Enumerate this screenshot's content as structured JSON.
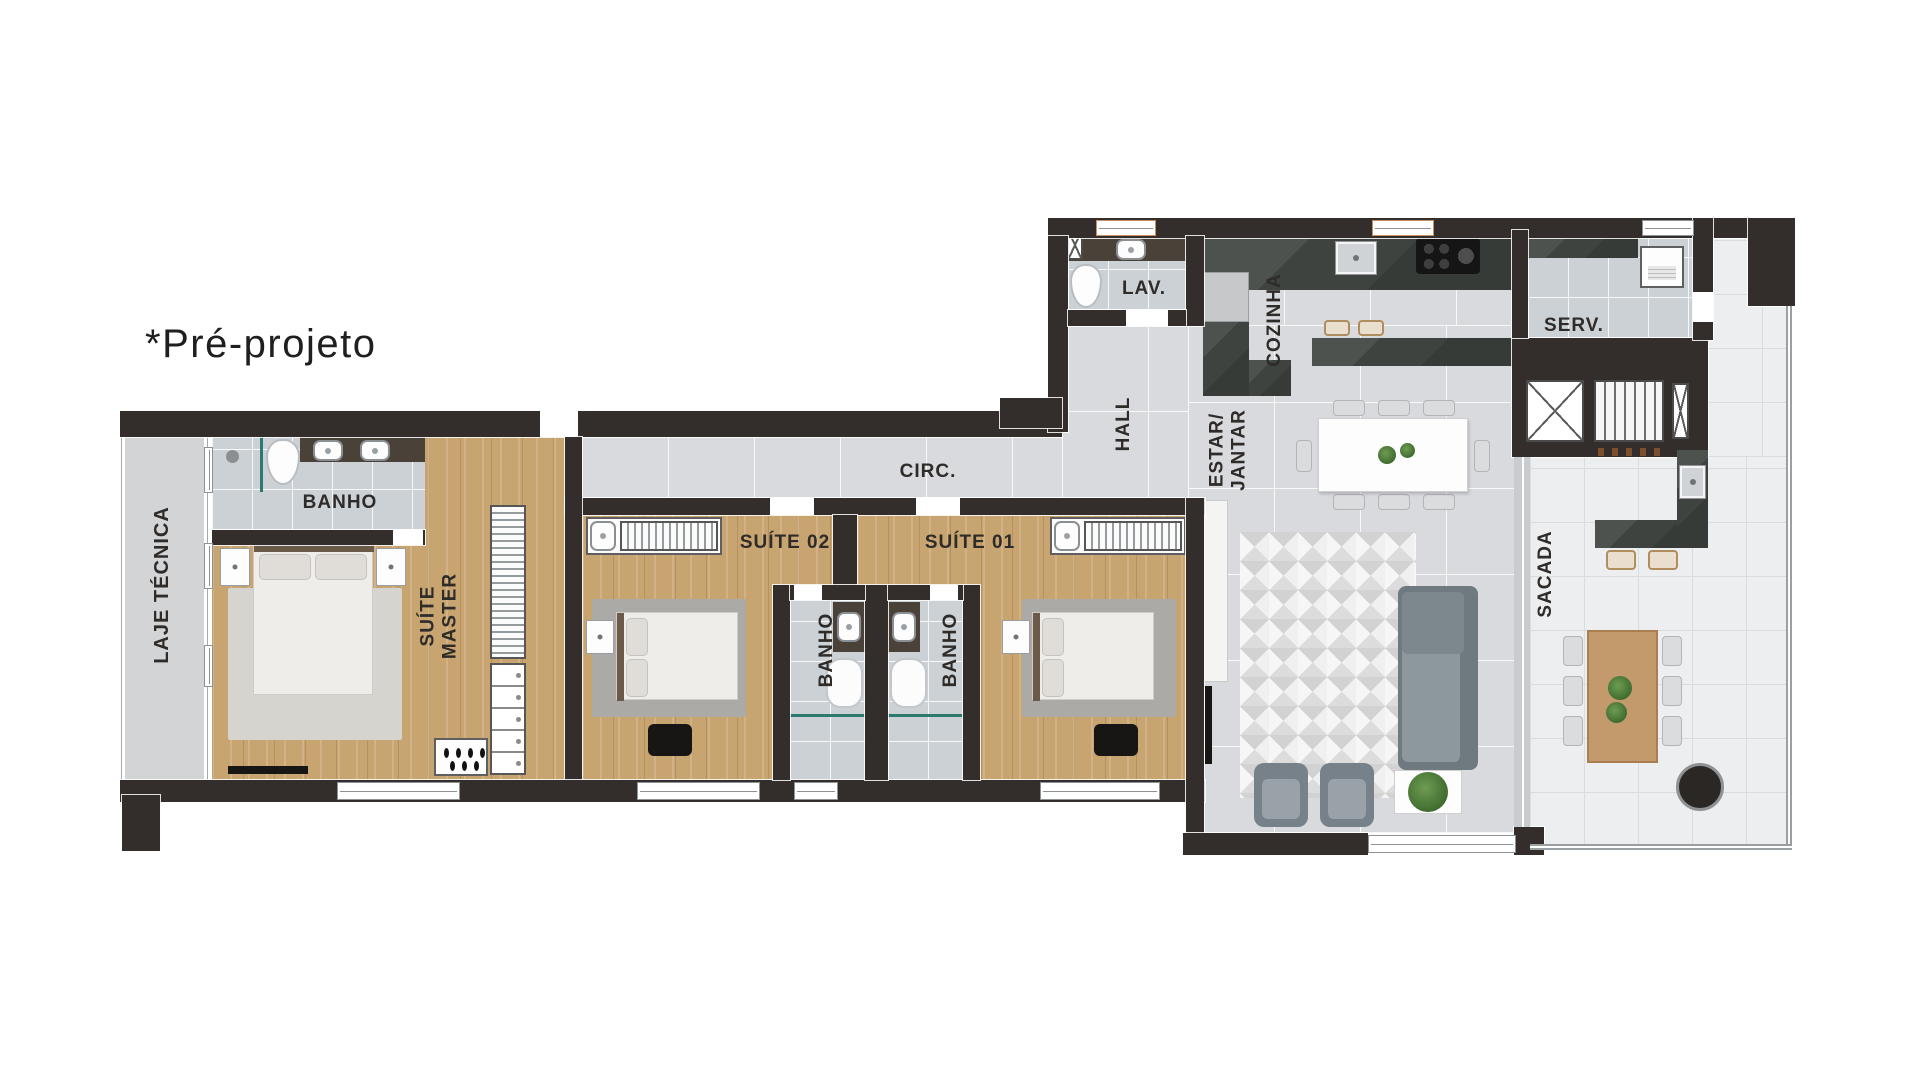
{
  "annotation": {
    "pre_projeto": "*Pré-projeto"
  },
  "rooms": {
    "laje_tecnica": "LAJE TÉCNICA",
    "banho_master": "BANHO",
    "suite_master_line1": "SUÍTE",
    "suite_master_line2": "MASTER",
    "suite_02": "SUÍTE 02",
    "suite_01": "SUÍTE 01",
    "banho_suite_02": "BANHO",
    "banho_suite_01": "BANHO",
    "circulacao": "CIRC.",
    "hall": "HALL",
    "lavabo": "LAV.",
    "cozinha": "COZINHA",
    "estar_jantar_line1": "ESTAR/",
    "estar_jantar_line2": "JANTAR",
    "servico": "SERV.",
    "sacada": "SACADA"
  },
  "palette": {
    "wall": "#332e2b",
    "wood_floor": "#c8a470",
    "marble_floor": "#d8dadd",
    "bath_tile": "#ccd1d5",
    "balcony_tile": "#eceeef",
    "counter_dark": "#3e433f",
    "counter_brown": "#4a4138",
    "shower_glass_teal": "#2c7a6f",
    "label_text": "#2e2b29",
    "sofa_gray": "#7c888d",
    "plant_green": "#4c7a39",
    "outdoor_wood": "#c29a6b"
  }
}
